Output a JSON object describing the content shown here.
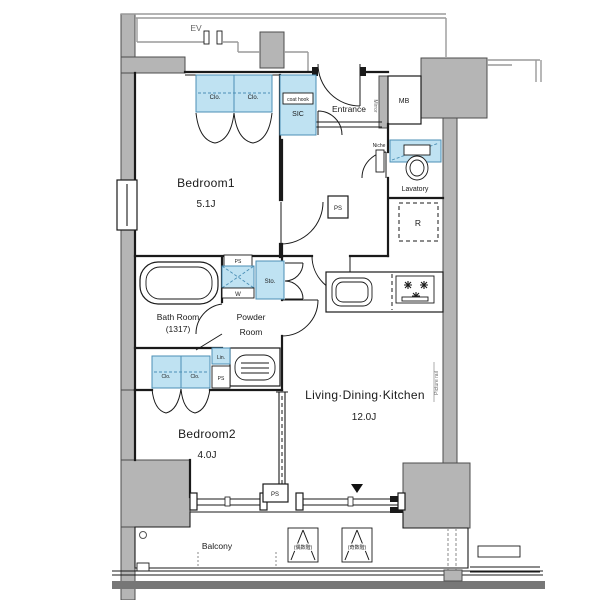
{
  "plan_title": "apartment floor plan",
  "colors": {
    "wall_gray": "#b5b5b5",
    "fixture_blue": "#bfe2f2",
    "fixture_blue_border": "#4b8fb5",
    "line": "#1a1a1a"
  },
  "rooms": {
    "bedroom1": {
      "name": "Bedroom1",
      "size": "5.1J"
    },
    "bedroom2": {
      "name": "Bedroom2",
      "size": "4.0J"
    },
    "ldk": {
      "name": "Living·Dining·Kitchen",
      "size": "12.0J"
    },
    "bath": {
      "name": "Bath Room",
      "size": "(1317)"
    },
    "powder": {
      "line1": "Powder",
      "line2": "Room"
    },
    "lavatory": {
      "name": "Lavatory"
    },
    "entrance": {
      "name": "Entrance"
    },
    "balcony": {
      "name": "Balcony"
    }
  },
  "fixtures": {
    "ev": "EV",
    "mb": "MB",
    "sic": "SIC",
    "coat_hook": "coat hook",
    "mirror": "Mirror",
    "niche": "Niche",
    "fridge": "R",
    "storage": "Sto.",
    "washer": "W",
    "linen": "Lin.",
    "closet": "Clo.",
    "pipe_space": "PS",
    "picture_rail": "Picture rail",
    "hatch_even": "(偶数階)",
    "hatch_odd": "(奇数階)"
  }
}
